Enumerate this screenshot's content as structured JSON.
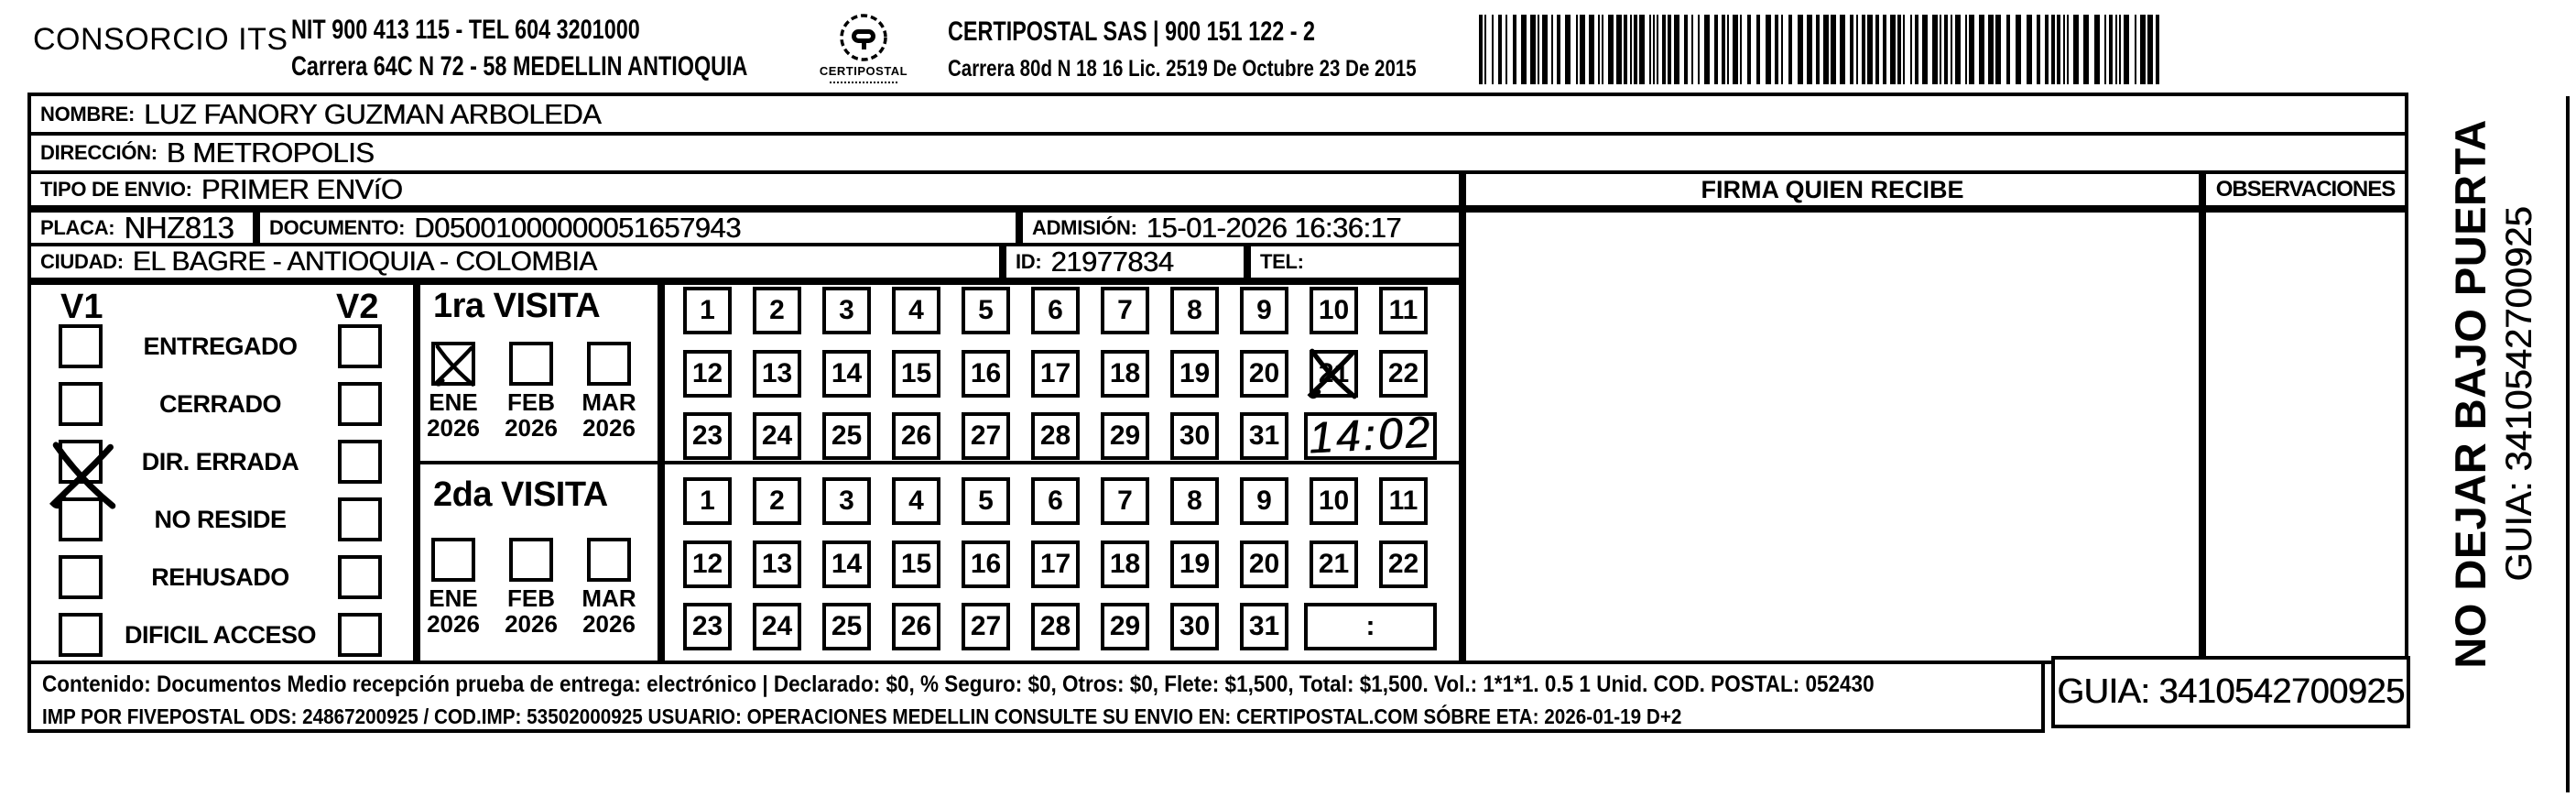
{
  "header": {
    "company": "CONSORCIO ITS",
    "nit_line1": "NIT 900 413 115 - TEL 604 3201000",
    "nit_line2": "Carrera 64C N 72 - 58 MEDELLIN ANTIOQUIA",
    "logo_text": "CERTIPOSTAL",
    "partner_line1": "CERTIPOSTAL SAS | 900 151 122 - 2",
    "partner_line2": "Carrera 80d N 18 16  Lic. 2519 De Octubre 23 De 2015"
  },
  "recipient": {
    "nombre_label": "NOMBRE:",
    "nombre": "LUZ FANORY GUZMAN ARBOLEDA",
    "direccion_label": "DIRECCIÓN:",
    "direccion": "B METROPOLIS",
    "tipo_envio_label": "TIPO DE ENVIO:",
    "tipo_envio": "PRIMER ENVíO",
    "placa_label": "PLACA:",
    "placa": "NHZ813",
    "documento_label": "DOCUMENTO:",
    "documento": "D05001000000051657943",
    "admision_label": "ADMISIÓN:",
    "admision": "15-01-2026 16:36:17",
    "ciudad_label": "CIUDAD:",
    "ciudad": "EL BAGRE - ANTIOQUIA - COLOMBIA",
    "id_label": "ID:",
    "id": "21977834",
    "tel_label": "TEL:",
    "tel": ""
  },
  "columns": {
    "firma_header": "FIRMA QUIEN RECIBE",
    "observaciones_header": "OBSERVACIONES"
  },
  "status_panel": {
    "col1_header": "V1",
    "col2_header": "V2",
    "options": [
      "ENTREGADO",
      "CERRADO",
      "DIR. ERRADA",
      "NO RESIDE",
      "REHUSADO",
      "DIFICIL ACCESO"
    ],
    "v1_checked_option": "DIR. ERRADA",
    "v2_checked_option": ""
  },
  "visits": [
    {
      "title": "1ra VISITA",
      "months": [
        {
          "label": "ENE",
          "year": "2026",
          "checked": true
        },
        {
          "label": "FEB",
          "year": "2026",
          "checked": false
        },
        {
          "label": "MAR",
          "year": "2026",
          "checked": false
        }
      ],
      "days": 31,
      "crossed_day": 21,
      "time_value": "14:02",
      "time_handwritten": true
    },
    {
      "title": "2da VISITA",
      "months": [
        {
          "label": "ENE",
          "year": "2026",
          "checked": false
        },
        {
          "label": "FEB",
          "year": "2026",
          "checked": false
        },
        {
          "label": "MAR",
          "year": "2026",
          "checked": false
        }
      ],
      "days": 31,
      "crossed_day": null,
      "time_value": ":",
      "time_handwritten": false
    }
  ],
  "footer": {
    "line1": "Contenido: Documentos Medio recepción prueba de entrega: electrónico | Declarado: $0, % Seguro: $0, Otros: $0, Flete: $1,500, Total: $1,500. Vol.: 1*1*1. 0.5  1 Unid. COD. POSTAL: 052430",
    "line2": "IMP POR FIVEPOSTAL ODS: 24867200925 / COD.IMP: 53502000925 USUARIO: OPERACIONES MEDELLIN CONSULTE SU ENVIO EN: CERTIPOSTAL.COM SÓBRE ETA: 2026-01-19 D+2",
    "guia_box": "GUIA: 3410542700925"
  },
  "side_label": {
    "warning": "NO DEJAR BAJO PUERTA",
    "guia": "GUIA: 3410542700925"
  }
}
